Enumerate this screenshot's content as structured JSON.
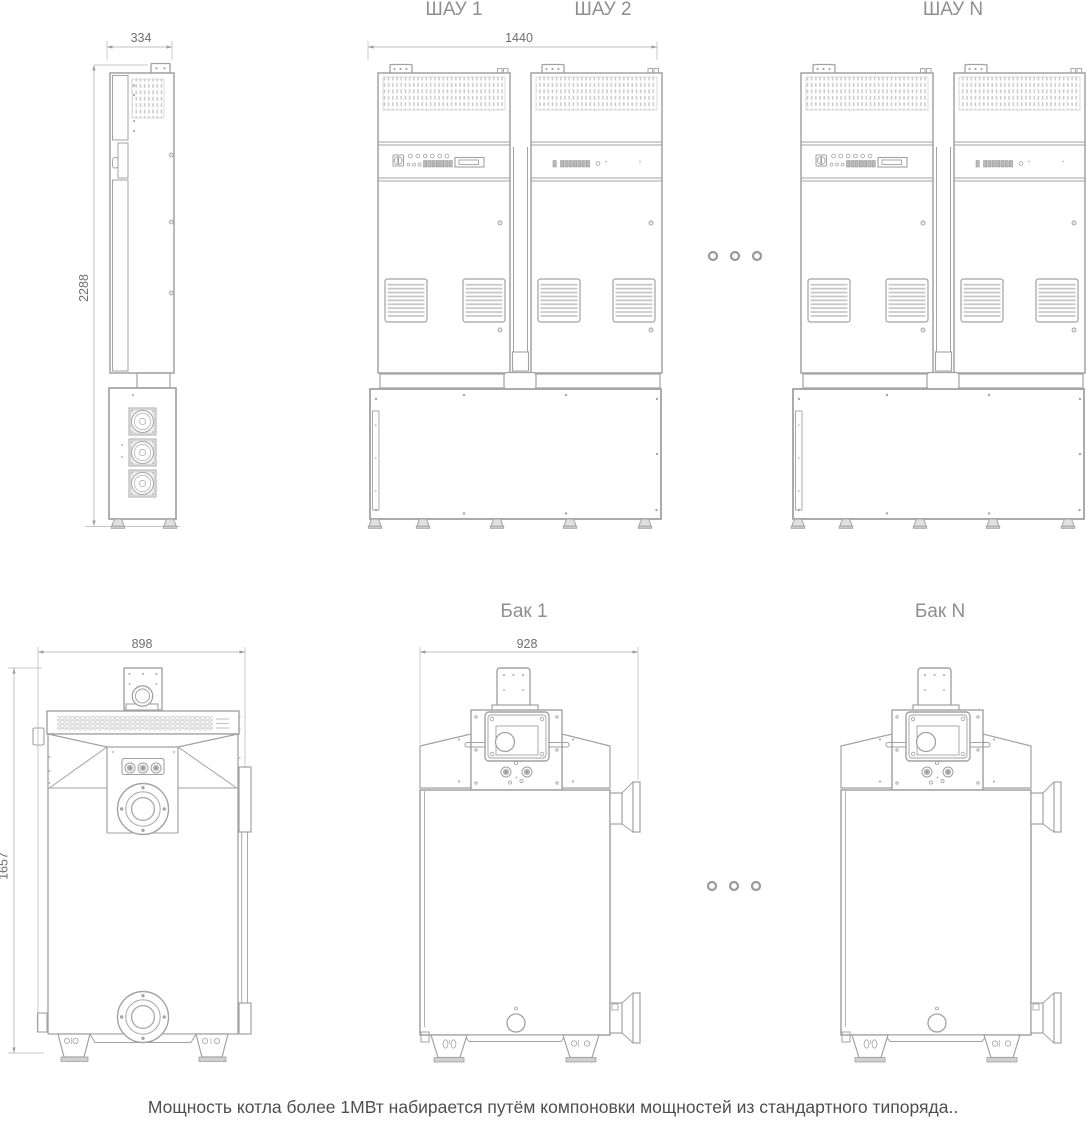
{
  "colors": {
    "background": "#ffffff",
    "line": "#a2a2a2",
    "line_light": "#c2c2c2",
    "detail_fill": "#c6c6c6",
    "dot": "#a6a6a6",
    "control_fill": "#b9b9b9",
    "label_text": "#8f8f8f",
    "dim_text": "#6f6f6f",
    "caption_text": "#4f4f4f"
  },
  "top_row": {
    "side_view": {
      "width_dim": "334",
      "height_dim": "2288"
    },
    "front_view": {
      "labels": [
        "ШАУ 1",
        "ШАУ 2"
      ],
      "width_dim": "1440"
    },
    "nth_view": {
      "label": "ШАУ N"
    }
  },
  "bottom_row": {
    "tank_front_view": {
      "width_dim": "898",
      "height_dim": "1657"
    },
    "tank_side_view": {
      "label": "Бак 1",
      "width_dim": "928"
    },
    "nth_tank_view": {
      "label": "Бак N"
    }
  },
  "caption": "Мощность котла более 1МВт набирается путём компоновки мощностей из стандартного типоряда.."
}
